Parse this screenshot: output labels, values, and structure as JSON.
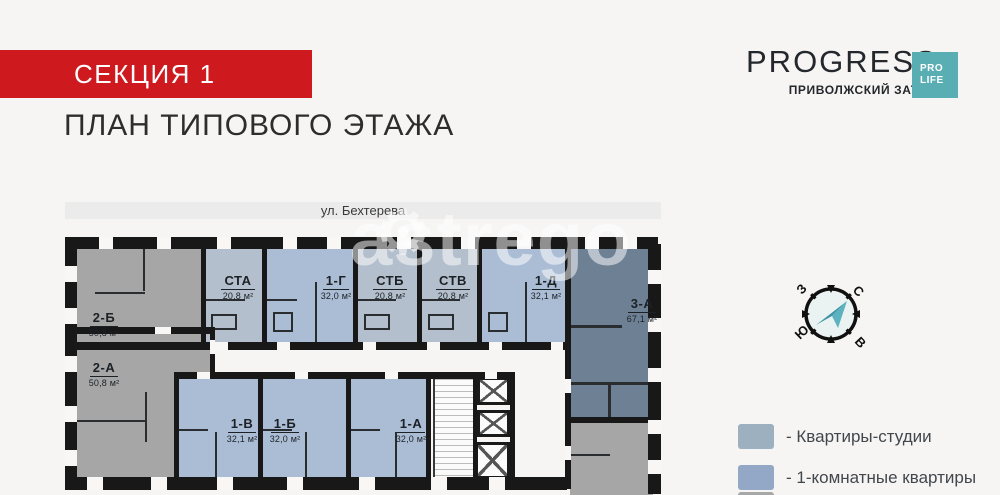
{
  "header": {
    "section": "СЕКЦИЯ 1",
    "title": "ПЛАН ТИПОВОГО ЭТАЖА"
  },
  "brand": {
    "name": "PROGRESS",
    "tagline": "ПРИВОЛЖСКИЙ ЗАТОН",
    "badge": [
      "PRO",
      "LIFE"
    ]
  },
  "plan": {
    "street": "ул. Бехтерева",
    "watermark": "astrego",
    "apartments": [
      {
        "name": "2-Б",
        "area": "50,8 м²",
        "type": "2-room"
      },
      {
        "name": "2-А",
        "area": "50,8 м²",
        "type": "2-room"
      },
      {
        "name": "СТА",
        "area": "20,8 м²",
        "type": "studio"
      },
      {
        "name": "1-Г",
        "area": "32,0 м²",
        "type": "1-room"
      },
      {
        "name": "СТБ",
        "area": "20,8 м²",
        "type": "studio"
      },
      {
        "name": "СТВ",
        "area": "20,8 м²",
        "type": "studio"
      },
      {
        "name": "1-Д",
        "area": "32,1 м²",
        "type": "1-room"
      },
      {
        "name": "3-А",
        "area": "67,1 м²",
        "type": "3-room"
      },
      {
        "name": "1-В",
        "area": "32,1 м²",
        "type": "1-room"
      },
      {
        "name": "1-Б",
        "area": "32,0 м²",
        "type": "1-room"
      },
      {
        "name": "1-А",
        "area": "32,0 м²",
        "type": "1-room"
      }
    ]
  },
  "compass": {
    "north": "С",
    "south": "Ю",
    "west": "З",
    "east": "В"
  },
  "legend": [
    {
      "label": "- Квартиры-студии",
      "color": "#9db0bf"
    },
    {
      "label": "- 1-комнатные квартиры",
      "color": "#93a8c7"
    }
  ],
  "colors": {
    "banner": "#ce1a1e",
    "badge": "#58aeb3",
    "studio": "#b3bfcc",
    "one_room": "#abbdd5",
    "two_room": "#a6a6a6",
    "three_room": "#6d8094",
    "wall": "#181818"
  }
}
